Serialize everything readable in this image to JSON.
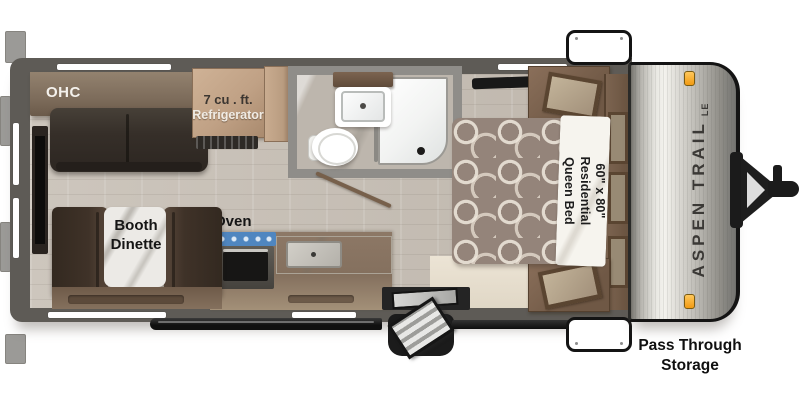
{
  "floorplan": {
    "brand": {
      "name": "ASPEN TRAIL",
      "edition": "LE"
    },
    "labels": {
      "ohc": "OHC",
      "refrigerator_line1": "7 cu . ft.",
      "refrigerator_line2": "Refrigerator",
      "oven": "Oven",
      "dinette_line1": "Booth",
      "dinette_line2": "Dinette",
      "bed_line1": "60\" x 80\"",
      "bed_line2": "Residential",
      "bed_line3": "Queen Bed",
      "pass_through_line1": "Pass Through",
      "pass_through_line2": "Storage"
    },
    "colors": {
      "wall": "#5e5b56",
      "floor": "#c8c1b8",
      "marker_light": "#f7a11e",
      "stove_top": "#4f86c0",
      "cap_text": "#3b3936"
    }
  }
}
